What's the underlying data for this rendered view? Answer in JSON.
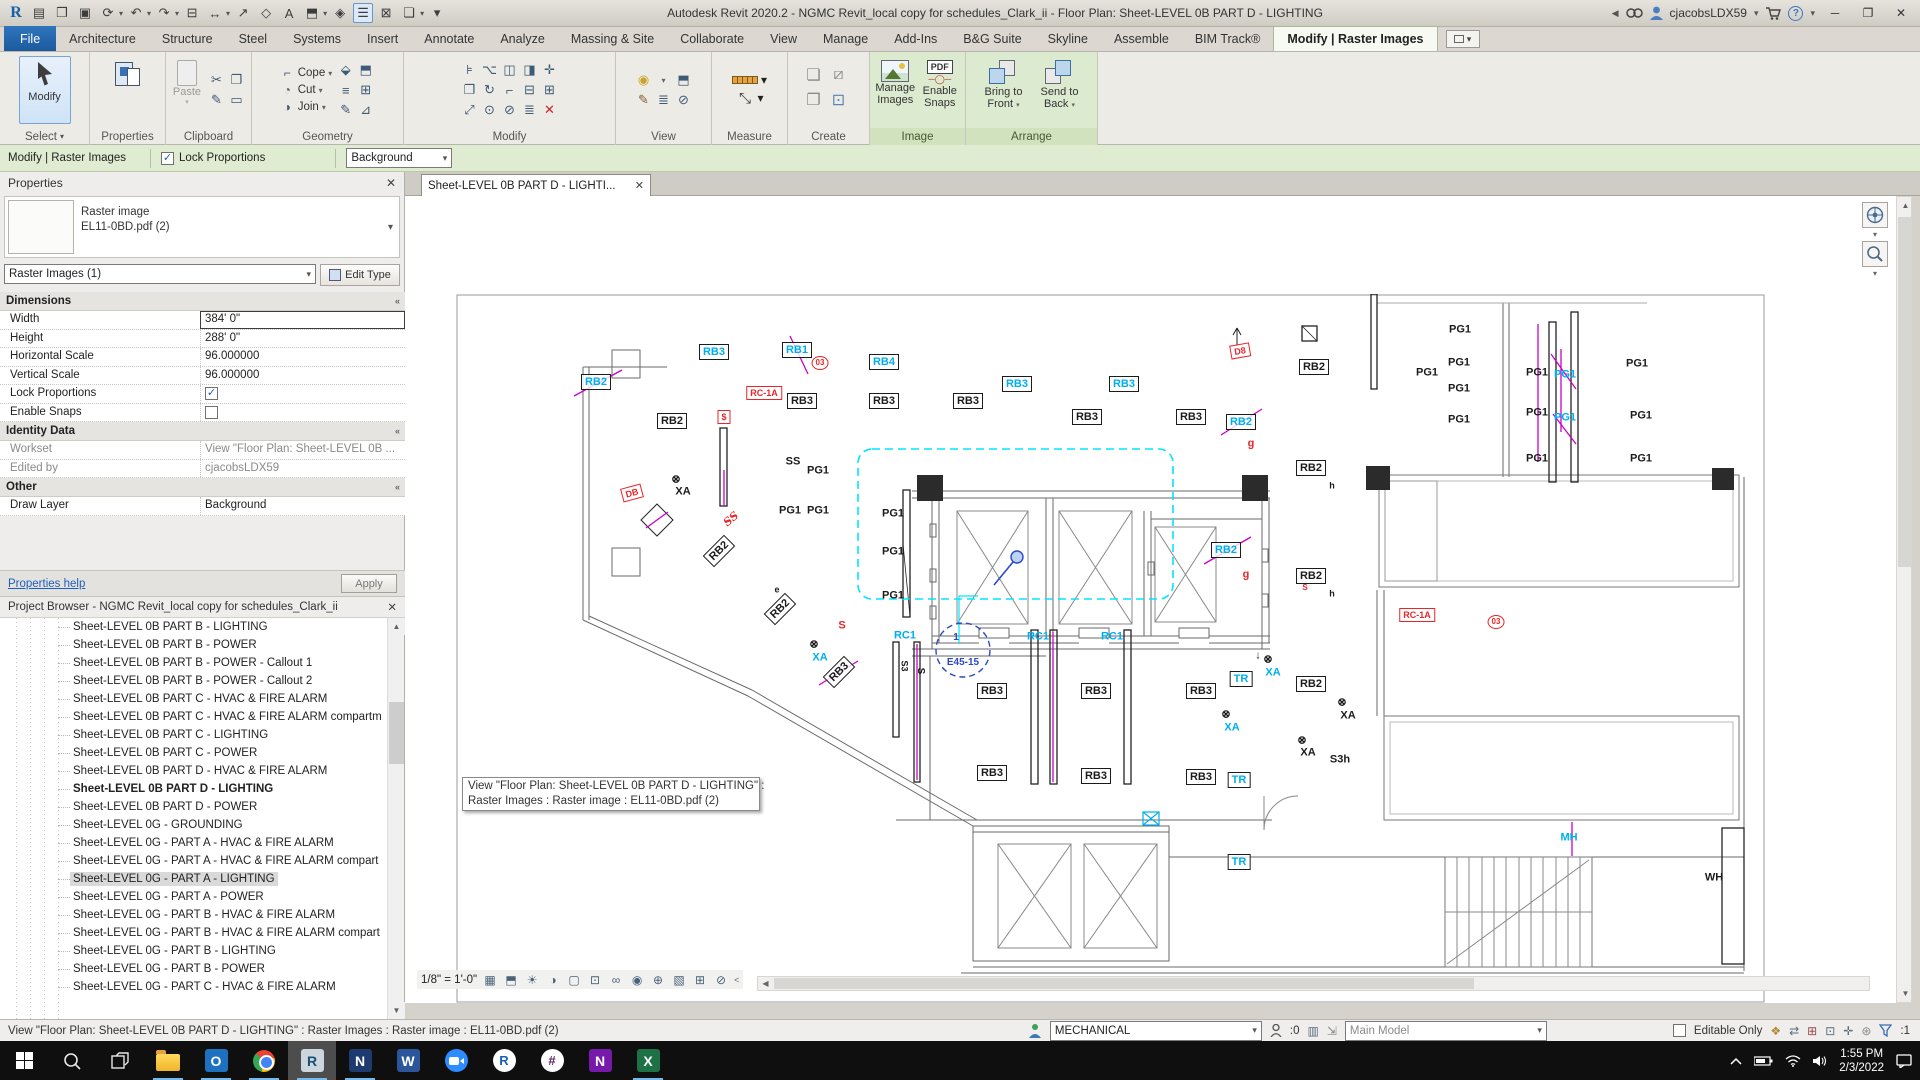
{
  "title_bar": {
    "app_title": "Autodesk Revit 2020.2 - NGMC Revit_local copy for schedules_Clark_ii - Floor Plan: Sheet-LEVEL 0B PART D - LIGHTING",
    "user": "cjacobsLDX59",
    "qat": [
      {
        "name": "revit-logo",
        "glyph": "R",
        "cls": "rlogo"
      },
      {
        "name": "properties-window-icon",
        "glyph": "▤"
      },
      {
        "name": "open-icon",
        "glyph": "❒"
      },
      {
        "name": "save-icon",
        "glyph": "▣"
      },
      {
        "name": "sync-with-central-icon",
        "glyph": "⟳",
        "drop": true
      },
      {
        "name": "undo-icon",
        "glyph": "↶",
        "drop": true
      },
      {
        "name": "redo-icon",
        "glyph": "↷",
        "drop": true
      },
      {
        "name": "print-icon",
        "glyph": "⊟"
      },
      {
        "name": "aligned-dimension-icon",
        "glyph": "↔",
        "drop": true
      },
      {
        "name": "measure-icon",
        "glyph": "↗"
      },
      {
        "name": "tag-icon",
        "glyph": "◇"
      },
      {
        "name": "text-icon",
        "glyph": "A"
      },
      {
        "name": "default-3d-view-icon",
        "glyph": "⬒",
        "drop": true
      },
      {
        "name": "section-icon",
        "glyph": "◈"
      },
      {
        "name": "thin-lines-icon",
        "glyph": "☰",
        "hl": true
      },
      {
        "name": "close-hidden-windows-icon",
        "glyph": "⊠"
      },
      {
        "name": "switch-windows-icon",
        "glyph": "❏",
        "drop": true
      },
      {
        "name": "qat-customize-icon",
        "glyph": "▾"
      }
    ]
  },
  "ribbon": {
    "tabs": [
      "File",
      "Architecture",
      "Structure",
      "Steel",
      "Systems",
      "Insert",
      "Annotate",
      "Analyze",
      "Massing & Site",
      "Collaborate",
      "View",
      "Manage",
      "Add-Ins",
      "B&G Suite",
      "Skyline",
      "Assemble",
      "BIM Track®"
    ],
    "active_tab": "Modify | Raster Images",
    "panel_labels": {
      "select": "Select",
      "properties": "Properties",
      "clipboard": "Clipboard",
      "geometry": "Geometry",
      "modify": "Modify",
      "view": "View",
      "measure": "Measure",
      "create": "Create",
      "image": "Image",
      "arrange": "Arrange"
    },
    "buttons": {
      "modify": "Modify",
      "paste": "Paste",
      "cope": "Cope",
      "cut": "Cut",
      "join": "Join",
      "manage_images_1": "Manage",
      "manage_images_2": "Images",
      "enable_snaps_1": "Enable",
      "enable_snaps_2": "Snaps",
      "bring_front_1": "Bring to",
      "bring_front_2": "Front",
      "send_back_1": "Send to",
      "send_back_2": "Back"
    },
    "modify_icons": [
      "align-icon",
      "offset-icon",
      "mirror-icon",
      "mirror-draw-icon",
      "move-icon",
      "copy-icon",
      "rotate-icon",
      "trim-icon",
      "split-icon",
      "array-icon",
      "scale-icon",
      "pin-icon",
      "unpin-icon",
      "match-icon",
      "delete-icon"
    ]
  },
  "options_bar": {
    "context_label": "Modify | Raster Images",
    "lock_proportions_label": "Lock Proportions",
    "lock_checked": "✓",
    "layer_value": "Background"
  },
  "properties_panel": {
    "title": "Properties",
    "type_line1": "Raster image",
    "type_line2": "EL11-0BD.pdf (2)",
    "filter_value": "Raster Images (1)",
    "edit_type_label": "Edit Type",
    "sections": [
      {
        "title": "Dimensions",
        "rows": [
          {
            "label": "Width",
            "value": "384'  0\"",
            "kind": "input-active"
          },
          {
            "label": "Height",
            "value": "288'  0\"",
            "kind": "input"
          },
          {
            "label": "Horizontal Scale",
            "value": "96.000000",
            "kind": "input"
          },
          {
            "label": "Vertical Scale",
            "value": "96.000000",
            "kind": "input"
          },
          {
            "label": "Lock Proportions",
            "kind": "checkbox",
            "checked": true
          },
          {
            "label": "Enable Snaps",
            "kind": "checkbox",
            "checked": false
          }
        ]
      },
      {
        "title": "Identity Data",
        "rows": [
          {
            "label": "Workset",
            "value": "View \"Floor Plan: Sheet-LEVEL 0B ...",
            "kind": "readonly"
          },
          {
            "label": "Edited by",
            "value": "cjacobsLDX59",
            "kind": "readonly"
          }
        ]
      },
      {
        "title": "Other",
        "rows": [
          {
            "label": "Draw Layer",
            "value": "Background",
            "kind": "input"
          }
        ]
      }
    ],
    "help_link": "Properties help",
    "apply_label": "Apply"
  },
  "project_browser": {
    "title": "Project Browser - NGMC Revit_local copy for schedules_Clark_ii",
    "items": [
      {
        "label": "Sheet-LEVEL 0B PART B - LIGHTING"
      },
      {
        "label": "Sheet-LEVEL 0B PART B - POWER"
      },
      {
        "label": "Sheet-LEVEL 0B PART B - POWER - Callout 1"
      },
      {
        "label": "Sheet-LEVEL 0B PART B - POWER - Callout 2"
      },
      {
        "label": "Sheet-LEVEL 0B PART C - HVAC & FIRE ALARM"
      },
      {
        "label": "Sheet-LEVEL 0B PART C - HVAC & FIRE ALARM compartm"
      },
      {
        "label": "Sheet-LEVEL 0B PART C - LIGHTING"
      },
      {
        "label": "Sheet-LEVEL 0B PART C - POWER"
      },
      {
        "label": "Sheet-LEVEL 0B PART D - HVAC & FIRE ALARM"
      },
      {
        "label": "Sheet-LEVEL 0B PART D - LIGHTING",
        "bold": true
      },
      {
        "label": "Sheet-LEVEL 0B PART D - POWER"
      },
      {
        "label": "Sheet-LEVEL 0G - GROUNDING"
      },
      {
        "label": "Sheet-LEVEL 0G - PART A - HVAC & FIRE ALARM"
      },
      {
        "label": "Sheet-LEVEL 0G - PART A - HVAC & FIRE ALARM compart"
      },
      {
        "label": "Sheet-LEVEL 0G - PART A - LIGHTING",
        "selected": true
      },
      {
        "label": "Sheet-LEVEL 0G - PART A - POWER"
      },
      {
        "label": "Sheet-LEVEL 0G - PART B - HVAC & FIRE ALARM"
      },
      {
        "label": "Sheet-LEVEL 0G - PART B - HVAC & FIRE ALARM compart"
      },
      {
        "label": "Sheet-LEVEL 0G - PART B - LIGHTING"
      },
      {
        "label": "Sheet-LEVEL 0G - PART B - POWER"
      },
      {
        "label": "Sheet-LEVEL 0G - PART C - HVAC & FIRE ALARM"
      }
    ]
  },
  "drawing": {
    "tab_label": "Sheet-LEVEL 0B PART D - LIGHTI...",
    "tooltip": [
      "View \"Floor Plan: Sheet-LEVEL 0B PART D - LIGHTING\" :",
      "Raster Images : Raster image : EL11-0BD.pdf (2)"
    ],
    "scale_label": "1/8\" = 1'-0\"",
    "viewbar_icons": [
      "detail-level-icon",
      "visual-style-icon",
      "sun-path-icon",
      "shadows-icon",
      "crop-view-icon",
      "show-crop-region-icon",
      "temporary-hide-isolate-icon",
      "reveal-hidden-elements-icon",
      "worksharing-display-icon",
      "temporary-view-properties-icon",
      "hide-analytical-model-icon",
      "reveal-constraints-icon"
    ],
    "colors": {
      "cyan": "#00AEEF",
      "red": "#E8262A",
      "blue": "#2B48C8",
      "magenta": "#C800C8",
      "black": "#1b1b1b"
    },
    "labels": [
      {
        "t": "RB3",
        "x": 258,
        "y": 58,
        "c": "cyan",
        "box": 1
      },
      {
        "t": "RB1",
        "x": 341,
        "y": 56,
        "c": "cyan",
        "box": 1
      },
      {
        "t": "03",
        "x": 364,
        "y": 69,
        "c": "red",
        "circ": 1,
        "fs": 8
      },
      {
        "t": "RB4",
        "x": 428,
        "y": 68,
        "c": "cyan",
        "box": 1
      },
      {
        "t": "RB3",
        "x": 346,
        "y": 107,
        "c": "black",
        "box": 1
      },
      {
        "t": "RB3",
        "x": 428,
        "y": 107,
        "c": "black",
        "box": 1
      },
      {
        "t": "RB3",
        "x": 512,
        "y": 107,
        "c": "black",
        "box": 1
      },
      {
        "t": "RB3",
        "x": 561,
        "y": 90,
        "c": "cyan",
        "box": 1
      },
      {
        "t": "RB3",
        "x": 668,
        "y": 90,
        "c": "cyan",
        "box": 1
      },
      {
        "t": "RB3",
        "x": 631,
        "y": 123,
        "c": "black",
        "box": 1
      },
      {
        "t": "RB3",
        "x": 735,
        "y": 123,
        "c": "black",
        "box": 1
      },
      {
        "t": "RB2",
        "x": 785,
        "y": 128,
        "c": "cyan",
        "box": 1
      },
      {
        "t": "RB2",
        "x": 858,
        "y": 73,
        "c": "black",
        "box": 1
      },
      {
        "t": "RB2",
        "x": 216,
        "y": 127,
        "c": "black",
        "box": 1
      },
      {
        "t": "RC-1A",
        "x": 308,
        "y": 99,
        "c": "red",
        "box": 1,
        "fs": 9
      },
      {
        "t": "$",
        "x": 268,
        "y": 123,
        "c": "red",
        "box": 1,
        "fs": 9
      },
      {
        "t": "RB2",
        "x": 140,
        "y": 88,
        "c": "cyan",
        "box": 1
      },
      {
        "t": "D8",
        "x": 784,
        "y": 57,
        "c": "red",
        "box": 1,
        "fs": 9,
        "rot": -10
      },
      {
        "t": "PG1",
        "x": 1004,
        "y": 36,
        "c": "black"
      },
      {
        "t": "PG1",
        "x": 1003,
        "y": 69,
        "c": "black"
      },
      {
        "t": "PG1",
        "x": 971,
        "y": 79,
        "c": "black"
      },
      {
        "t": "PG1",
        "x": 1003,
        "y": 95,
        "c": "black"
      },
      {
        "t": "PG1",
        "x": 1081,
        "y": 79,
        "c": "black"
      },
      {
        "t": "PG1",
        "x": 1109,
        "y": 81,
        "c": "cyan"
      },
      {
        "t": "PG1",
        "x": 1081,
        "y": 119,
        "c": "black"
      },
      {
        "t": "PG1",
        "x": 1109,
        "y": 124,
        "c": "cyan"
      },
      {
        "t": "PG1",
        "x": 1003,
        "y": 126,
        "c": "black"
      },
      {
        "t": "PG1",
        "x": 1081,
        "y": 165,
        "c": "black"
      },
      {
        "t": "PG1",
        "x": 1185,
        "y": 122,
        "c": "black"
      },
      {
        "t": "PG1",
        "x": 1185,
        "y": 165,
        "c": "black"
      },
      {
        "t": "PG1",
        "x": 1181,
        "y": 70,
        "c": "black"
      },
      {
        "t": "SS",
        "x": 337,
        "y": 168,
        "c": "black"
      },
      {
        "t": "PG1",
        "x": 362,
        "y": 177,
        "c": "black"
      },
      {
        "t": "PG1",
        "x": 334,
        "y": 217,
        "c": "black"
      },
      {
        "t": "PG1",
        "x": 362,
        "y": 217,
        "c": "black"
      },
      {
        "t": "PG1",
        "x": 437,
        "y": 220,
        "c": "black"
      },
      {
        "t": "PG1",
        "x": 437,
        "y": 258,
        "c": "black"
      },
      {
        "t": "PG1",
        "x": 437,
        "y": 302,
        "c": "black"
      },
      {
        "t": "SS",
        "x": 275,
        "y": 225,
        "c": "red",
        "rot": -40,
        "it": 1
      },
      {
        "t": "RB2",
        "x": 263,
        "y": 257,
        "c": "black",
        "box": 1,
        "rot": -45
      },
      {
        "t": "RB2",
        "x": 324,
        "y": 315,
        "c": "black",
        "box": 1,
        "rot": -45
      },
      {
        "t": "XA",
        "x": 227,
        "y": 198,
        "c": "black"
      },
      {
        "t": "⊗",
        "x": 220,
        "y": 186,
        "c": "black"
      },
      {
        "t": "DB",
        "x": 176,
        "y": 199,
        "c": "red",
        "box": 1,
        "fs": 9,
        "rot": -15
      },
      {
        "t": "e",
        "x": 321,
        "y": 296,
        "c": "black",
        "fs": 9
      },
      {
        "t": "S",
        "x": 386,
        "y": 332,
        "c": "red"
      },
      {
        "t": "XA",
        "x": 364,
        "y": 364,
        "c": "cyan"
      },
      {
        "t": "⊗",
        "x": 358,
        "y": 351,
        "c": "black"
      },
      {
        "t": "RB3",
        "x": 383,
        "y": 378,
        "c": "black",
        "box": 1,
        "rot": -45
      },
      {
        "t": "RC1",
        "x": 449,
        "y": 342,
        "c": "cyan"
      },
      {
        "t": "RC1",
        "x": 582,
        "y": 343,
        "c": "cyan"
      },
      {
        "t": "RC1",
        "x": 656,
        "y": 343,
        "c": "cyan"
      },
      {
        "t": "E45-15",
        "x": 507,
        "y": 369,
        "c": "blue",
        "fs": 10
      },
      {
        "t": "1",
        "x": 500,
        "y": 344,
        "c": "blue",
        "fs": 10
      },
      {
        "t": "RB2",
        "x": 855,
        "y": 174,
        "c": "black",
        "box": 1
      },
      {
        "t": "h",
        "x": 876,
        "y": 192,
        "c": "black",
        "fs": 9
      },
      {
        "t": "RB2",
        "x": 855,
        "y": 282,
        "c": "black",
        "box": 1
      },
      {
        "t": "h",
        "x": 876,
        "y": 300,
        "c": "black",
        "fs": 9
      },
      {
        "t": "RB2",
        "x": 770,
        "y": 256,
        "c": "cyan",
        "box": 1
      },
      {
        "t": "g",
        "x": 795,
        "y": 150,
        "c": "red"
      },
      {
        "t": "g",
        "x": 790,
        "y": 281,
        "c": "red"
      },
      {
        "t": "RC-1A",
        "x": 961,
        "y": 321,
        "c": "red",
        "box": 1,
        "fs": 9
      },
      {
        "t": "03",
        "x": 1040,
        "y": 328,
        "c": "red",
        "circ": 1,
        "fs": 8
      },
      {
        "t": "RB2",
        "x": 855,
        "y": 390,
        "c": "black",
        "box": 1
      },
      {
        "t": "RB3",
        "x": 536,
        "y": 397,
        "c": "black",
        "box": 1
      },
      {
        "t": "RB3",
        "x": 640,
        "y": 397,
        "c": "black",
        "box": 1
      },
      {
        "t": "RB3",
        "x": 745,
        "y": 397,
        "c": "black",
        "box": 1
      },
      {
        "t": "RB3",
        "x": 536,
        "y": 479,
        "c": "black",
        "box": 1
      },
      {
        "t": "RB3",
        "x": 640,
        "y": 482,
        "c": "black",
        "box": 1
      },
      {
        "t": "RB3",
        "x": 745,
        "y": 483,
        "c": "black",
        "box": 1
      },
      {
        "t": "TR",
        "x": 785,
        "y": 385,
        "c": "cyan",
        "box": 1
      },
      {
        "t": "TR",
        "x": 783,
        "y": 486,
        "c": "cyan",
        "box": 1
      },
      {
        "t": "TR",
        "x": 783,
        "y": 568,
        "c": "cyan",
        "box": 1
      },
      {
        "t": "XA",
        "x": 817,
        "y": 379,
        "c": "cyan"
      },
      {
        "t": "⊗",
        "x": 812,
        "y": 366,
        "c": "black"
      },
      {
        "t": "↓",
        "x": 802,
        "y": 362,
        "c": "black"
      },
      {
        "t": "XA",
        "x": 892,
        "y": 422,
        "c": "black"
      },
      {
        "t": "⊗",
        "x": 886,
        "y": 409,
        "c": "black"
      },
      {
        "t": "XA",
        "x": 852,
        "y": 459,
        "c": "black"
      },
      {
        "t": "⊗",
        "x": 846,
        "y": 447,
        "c": "black"
      },
      {
        "t": "XA",
        "x": 776,
        "y": 434,
        "c": "cyan"
      },
      {
        "t": "⊗",
        "x": 770,
        "y": 421,
        "c": "black"
      },
      {
        "t": "S3h",
        "x": 884,
        "y": 466,
        "c": "black"
      },
      {
        "t": "MH",
        "x": 1113,
        "y": 544,
        "c": "cyan"
      },
      {
        "t": "WH",
        "x": 1258,
        "y": 584,
        "c": "black"
      },
      {
        "t": "S3",
        "x": 448,
        "y": 372,
        "c": "black",
        "rot": 90,
        "fs": 9
      },
      {
        "t": "S",
        "x": 464,
        "y": 377,
        "c": "black",
        "rot": 90,
        "fs": 10
      },
      {
        "t": "S",
        "x": 849,
        "y": 294,
        "c": "red",
        "fs": 8
      }
    ]
  },
  "status_bar": {
    "message": "View \"Floor Plan: Sheet-LEVEL 0B PART D - LIGHTING\" : Raster Images : Raster image : EL11-0BD.pdf (2)",
    "workset_value": "MECHANICAL",
    "editing_requests": ":0",
    "design_option_value": "Main Model",
    "editable_only_label": "Editable Only",
    "filter_count": ":1",
    "icon_names": [
      "status-worksets-icon",
      "status-requests-icon",
      "status-worksets-dialog-icon",
      "status-arrow-icon",
      "status-keynote-icon",
      "status-select-link-icon",
      "status-select-pinned-icon",
      "status-select-element-icon",
      "status-drag-icon",
      "status-gear-icon",
      "status-filter-icon"
    ]
  },
  "taskbar": {
    "time": "1:55 PM",
    "date": "2/3/2022",
    "apps": [
      {
        "name": "file-explorer",
        "shape": "folder",
        "running": true
      },
      {
        "name": "outlook",
        "shape": "tile",
        "glyph": "O",
        "bg": "#1e70c1",
        "running": true
      },
      {
        "name": "chrome",
        "shape": "chrome",
        "running": true
      },
      {
        "name": "revit",
        "shape": "tile",
        "glyph": "R",
        "bg": "#cdd6dd",
        "fg": "#1a4f72",
        "running": true,
        "active": true
      },
      {
        "name": "notepad",
        "shape": "tile",
        "glyph": "N",
        "bg": "#1d3b6e",
        "running": true
      },
      {
        "name": "word",
        "shape": "tile",
        "glyph": "W",
        "bg": "#2b579a"
      },
      {
        "name": "zoom",
        "shape": "zoom"
      },
      {
        "name": "bluebeam-revu",
        "shape": "circle",
        "glyph": "R",
        "bg": "#ffffff",
        "fg": "#1b62b7"
      },
      {
        "name": "slack",
        "shape": "circle",
        "glyph": "#",
        "bg": "#ffffff",
        "fg": "#611f69"
      },
      {
        "name": "onenote",
        "shape": "tile",
        "glyph": "N",
        "bg": "#7719aa"
      },
      {
        "name": "excel",
        "shape": "tile",
        "glyph": "X",
        "bg": "#1e7145",
        "running": true
      }
    ]
  }
}
